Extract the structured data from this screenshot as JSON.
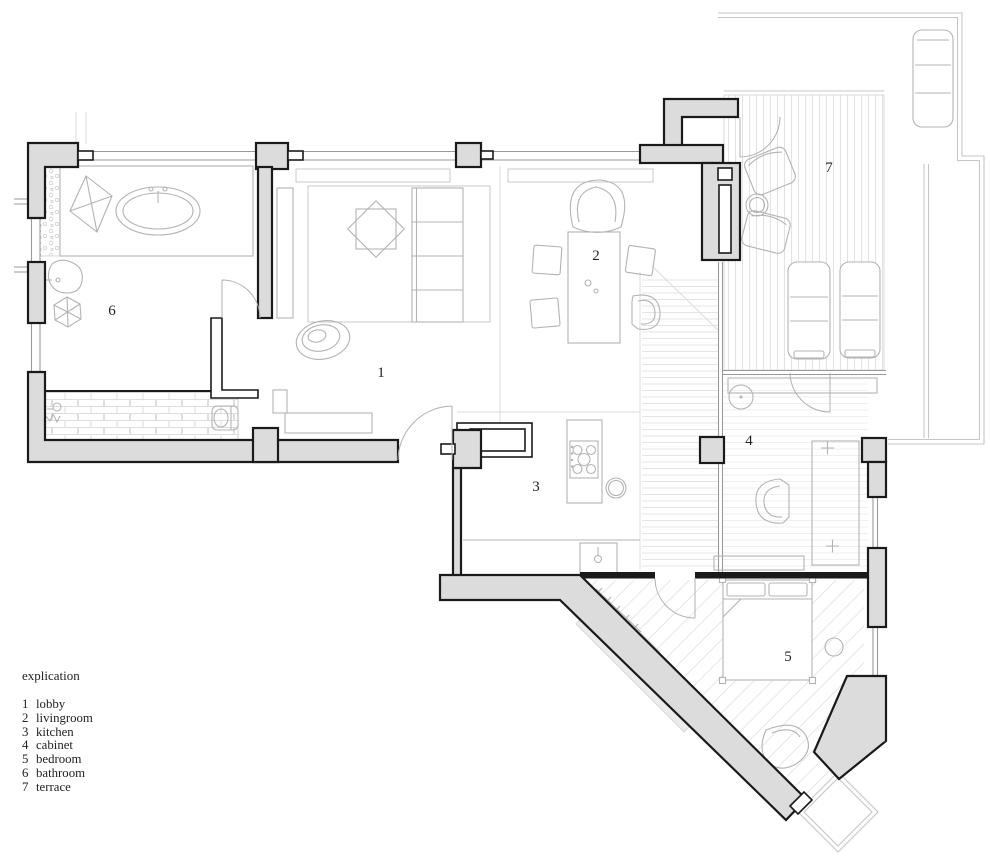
{
  "legend": {
    "title": "explication",
    "items": [
      {
        "num": "1",
        "label": "lobby"
      },
      {
        "num": "2",
        "label": "livingroom"
      },
      {
        "num": "3",
        "label": "kitchen"
      },
      {
        "num": "4",
        "label": "cabinet"
      },
      {
        "num": "5",
        "label": "bedroom"
      },
      {
        "num": "6",
        "label": "bathroom"
      },
      {
        "num": "7",
        "label": "terrace"
      }
    ]
  },
  "rooms": [
    {
      "num": "1",
      "label": "lobby",
      "x": 381,
      "y": 377
    },
    {
      "num": "2",
      "label": "livingroom",
      "x": 596,
      "y": 260
    },
    {
      "num": "3",
      "label": "kitchen",
      "x": 536,
      "y": 491
    },
    {
      "num": "4",
      "label": "cabinet",
      "x": 749,
      "y": 445
    },
    {
      "num": "5",
      "label": "bedroom",
      "x": 788,
      "y": 661
    },
    {
      "num": "6",
      "label": "bathroom",
      "x": 112,
      "y": 315
    },
    {
      "num": "7",
      "label": "terrace",
      "x": 829,
      "y": 172
    }
  ],
  "colors": {
    "wall_fill": "#dcdcdc",
    "wall_stroke": "#1a1a1a",
    "furniture_line": "#b3b3b3",
    "boundary_line": "#c6c6c6",
    "text_color": "#222222"
  }
}
